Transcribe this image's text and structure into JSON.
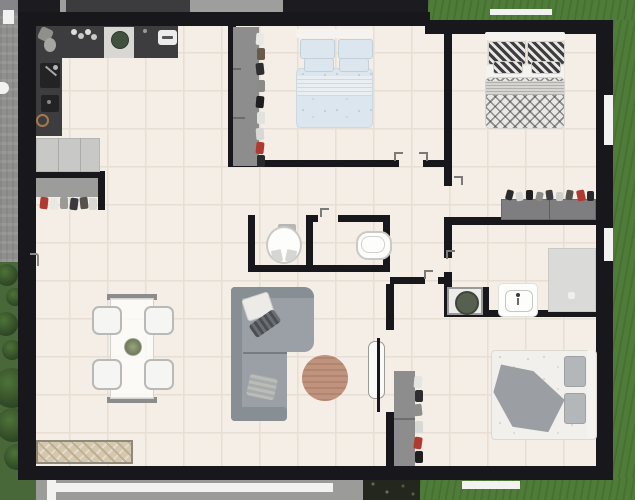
{
  "app": {
    "type": "floor-plan-2d-view",
    "visible_text": "none"
  },
  "canvas": {
    "width": 635,
    "height": 500
  },
  "colors": {
    "wall": "#17171c",
    "floor": "#f4eee6",
    "grout": "#e7dfd3",
    "grass": "#4f7d39",
    "garden": "#49683a",
    "bush-dark": "#2c4323",
    "grass-bright": "#609445",
    "pavement": "#8f8f8d",
    "walkway-white": "#f2f2f0",
    "outside-gray-bar": "#9e9e9c",
    "outside-dark": "#1b1b20",
    "awning-dark": "#3c3c3e",
    "plantbed-dark": "#23271e",
    "counter": "#3d3d40",
    "counter-inset": "#232326",
    "cooktop": "#d8d7d4",
    "burner": "#42513f",
    "appliance-white": "#ececea",
    "fridge": "#c8c8c6",
    "closet": "#9c9c9a",
    "dresser": "#7e7e80",
    "wardrobe": "#8d8d8e",
    "sofa": "#9aa0a5",
    "sofa-dark": "#878e94",
    "rug": "#bf937e",
    "table-bar": "#8c8c8a",
    "chair": "#f5f5f3",
    "chair-border": "#b9b9b6",
    "sideboard": "#d5c8b0",
    "sideboard-line": "#bfae8f",
    "bed-white": "#f4f3f0",
    "bed1-fabric": "#dce6ee",
    "bed1-band": "#e9eef3",
    "bed2-pattern": "#3e3e40",
    "bed2-base": "#e9e8e5",
    "bed2-band": "#d6d5d2",
    "bed3-blanket": "#9b9ea2",
    "bed3-pillow": "#b4b7ba",
    "fixture-white": "#fdfdfc",
    "fixture-border": "#c9c9c5",
    "washer-drum": "#57604f",
    "shower": "#dadad8",
    "accent-red": "#b03a30"
  },
  "items": {
    "kitchen_counter": "kitchen-counter-l-shape",
    "kitchen_sink": "kitchen-sink",
    "cooktop": "cooktop-with-burner",
    "fridge": "fridge-cabinet",
    "entry_closet": "open-entry-closet-with-clothes",
    "dining_table": "dining-table-glass",
    "dining_chairs": "4-white-tub-chairs",
    "centerpiece": "flower-centerpiece",
    "sideboard": "herringbone-wood-sideboard",
    "sofa": "gray-corner-sofa",
    "rug": "round-wooden-rug",
    "toilet1": "toilet-wc-1",
    "toilet2": "toilet-wc-2",
    "washer": "washing-machine",
    "bath_sink": "bathroom-sink",
    "shower": "walk-in-shower",
    "bed1": "double-bed-blue-bedding",
    "bed2": "double-bed-diamond-pattern-bedding",
    "bed3": "double-bed-gray-throw",
    "wardrobe1": "open-wardrobe-bedroom-1",
    "wardrobe3": "open-wardrobe-bedroom-3",
    "dresser2": "dresser-bedroom-2",
    "door_bed3": "open-door-bedroom-3",
    "front_door": "front-door-handle"
  },
  "rooms": [
    {
      "name": "kitchen-living-open-space",
      "furniture": [
        "kitchen-counter-l-shape",
        "kitchen-sink",
        "cooktop",
        "fridge-cabinet",
        "open-entry-closet-with-clothes",
        "dining-table-glass",
        "4-white-tub-chairs",
        "herringbone-wood-sideboard",
        "gray-corner-sofa",
        "round-wooden-rug"
      ]
    },
    {
      "name": "bedroom-top-middle",
      "furniture": [
        "double-bed-blue-bedding",
        "open-wardrobe-bedroom-1"
      ]
    },
    {
      "name": "bedroom-top-right",
      "furniture": [
        "double-bed-diamond-pattern-bedding",
        "dresser-bedroom-2"
      ]
    },
    {
      "name": "wc-1",
      "furniture": [
        "toilet-wc-1"
      ]
    },
    {
      "name": "wc-2",
      "furniture": [
        "toilet-wc-2"
      ]
    },
    {
      "name": "bathroom",
      "furniture": [
        "washing-machine",
        "bathroom-sink",
        "walk-in-shower"
      ]
    },
    {
      "name": "bedroom-bottom-right",
      "furniture": [
        "double-bed-gray-throw",
        "open-wardrobe-bedroom-3"
      ]
    }
  ],
  "openings": {
    "windows": [
      "right-wall-window-top",
      "right-wall-window-middle",
      "bottom-wall-window",
      "top-grass-window-strip"
    ],
    "doors": [
      "bedroom-1-door",
      "bedroom-2-door",
      "bathroom-door",
      "hall-door",
      "wc-2-door",
      "bedroom-3-open-door",
      "front-door"
    ]
  },
  "outside": {
    "top_left": "paved-driveway",
    "top_right": "lawn",
    "right": "lawn",
    "bottom_left": "garden-with-bushes",
    "bottom": "white-walkway-and-planting-bed"
  }
}
